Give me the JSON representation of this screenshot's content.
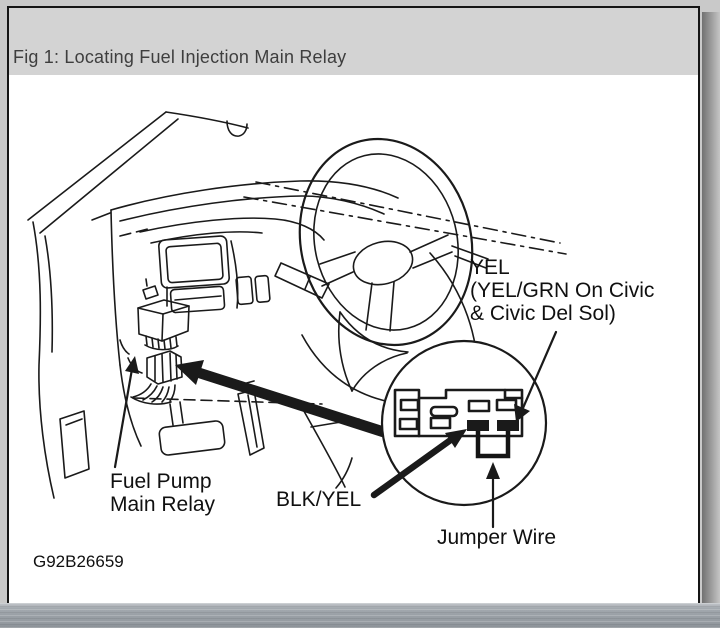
{
  "colors": {
    "ink": "#1a1a1a",
    "page_bg": "#ffffff",
    "header_bg": "#d3d3d3",
    "title_color": "#3e3e3e",
    "taskbar_base": "#9aa0a6"
  },
  "header": {
    "title": "Fig 1: Locating Fuel Injection Main Relay"
  },
  "diagram": {
    "labels": {
      "yel_line1": "YEL",
      "yel_line2": "(YEL/GRN On Civic",
      "yel_line3": "& Civic Del Sol)",
      "fuel_pump_line1": "Fuel Pump",
      "fuel_pump_line2": "Main Relay",
      "blk_yel": "BLK/YEL",
      "jumper_wire": "Jumper Wire",
      "figure_code": "G92B26659"
    }
  }
}
